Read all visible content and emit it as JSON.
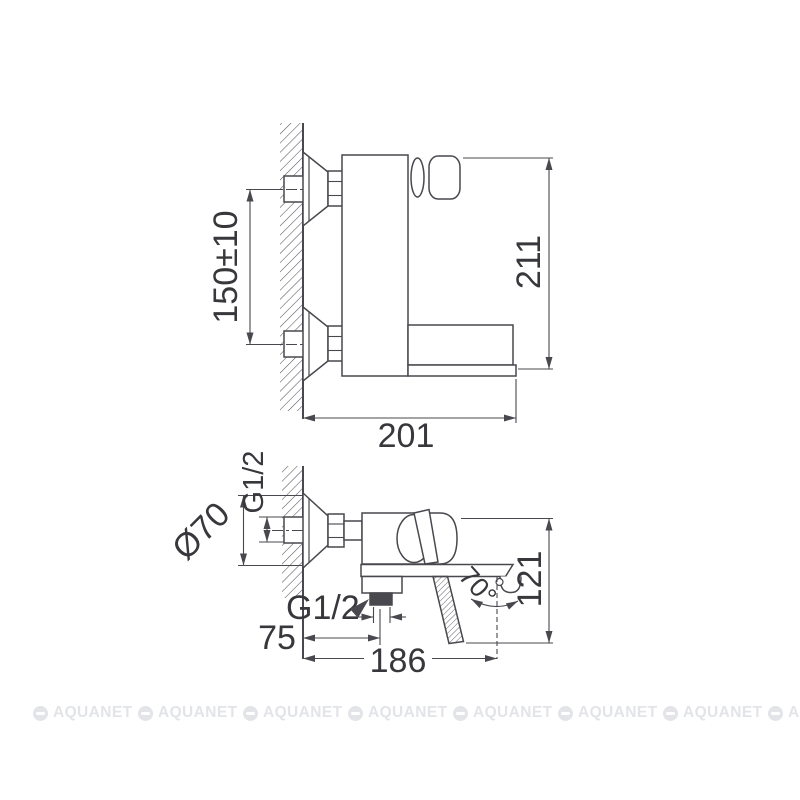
{
  "drawing": {
    "side_view": {
      "inlet_spacing": "150±10",
      "height_overall": "211",
      "spout_length": "201"
    },
    "plan_view": {
      "flange_diameter": "Ø70",
      "inlet_thread": "G1/2",
      "outlet_thread": "G1/2",
      "outlet_offset": "75",
      "spout_reach": "186",
      "depth_overall": "121",
      "handle_swing_angle": "70°"
    }
  },
  "watermark": {
    "label": "AQUANET"
  },
  "colors": {
    "line": "#48484e",
    "text": "#37373c",
    "watermark": "#e2e4e8",
    "background": "#ffffff"
  }
}
